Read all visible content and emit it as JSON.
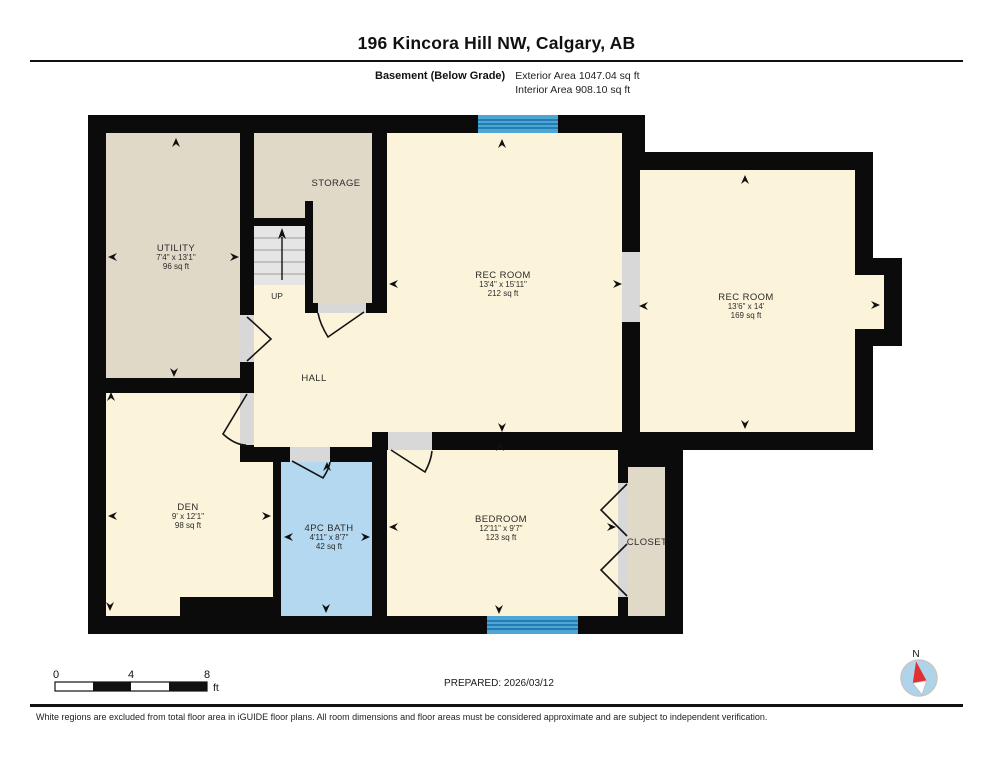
{
  "header": {
    "title": "196 Kincora Hill NW, Calgary, AB",
    "floor_label": "Basement (Below Grade)",
    "exterior_area": "Exterior Area 1047.04 sq ft",
    "interior_area": "Interior Area 908.10 sq ft"
  },
  "rooms": [
    {
      "id": "utility",
      "name": "UTILITY",
      "dims": "7'4\" x 13'1\"",
      "area": "96 sq ft"
    },
    {
      "id": "storage",
      "name": "STORAGE"
    },
    {
      "id": "rec-room-main",
      "name": "REC ROOM",
      "dims": "13'4\" x 15'11\"",
      "area": "212 sq ft"
    },
    {
      "id": "rec-room-right",
      "name": "REC ROOM",
      "dims": "13'6\" x 14'",
      "area": "169 sq ft"
    },
    {
      "id": "hall",
      "name": "HALL"
    },
    {
      "id": "den",
      "name": "DEN",
      "dims": "9' x 12'1\"",
      "area": "98 sq ft"
    },
    {
      "id": "bath",
      "name": "4PC BATH",
      "dims": "4'11\" x 8'7\"",
      "area": "42 sq ft"
    },
    {
      "id": "bedroom",
      "name": "BEDROOM",
      "dims": "12'11\" x 9'7\"",
      "area": "123 sq ft"
    },
    {
      "id": "closet",
      "name": "CLOSET"
    }
  ],
  "stairs": {
    "label": "UP"
  },
  "scale_bar": {
    "start": "0",
    "mid": "4",
    "end": "8",
    "unit": "ft"
  },
  "prepared": "PREPARED: 2026/03/12",
  "compass": {
    "label": "N"
  },
  "footer": "White regions are excluded from total floor area in iGUIDE floor plans. All room dimensions and floor areas must be considered approximate and are subject to independent verification.",
  "colors": {
    "wall": "#0b0b0b",
    "room_cream": "#FBF4DA",
    "room_tan": "#E1D9C8",
    "bath_blue": "#B3D8F0",
    "window_blue": "#4CA7D6",
    "stairs_gray": "#E5E5E5",
    "opening_gray": "#D8D8D8",
    "compass_red": "#E03131",
    "compass_blue": "#AFD4EA"
  }
}
